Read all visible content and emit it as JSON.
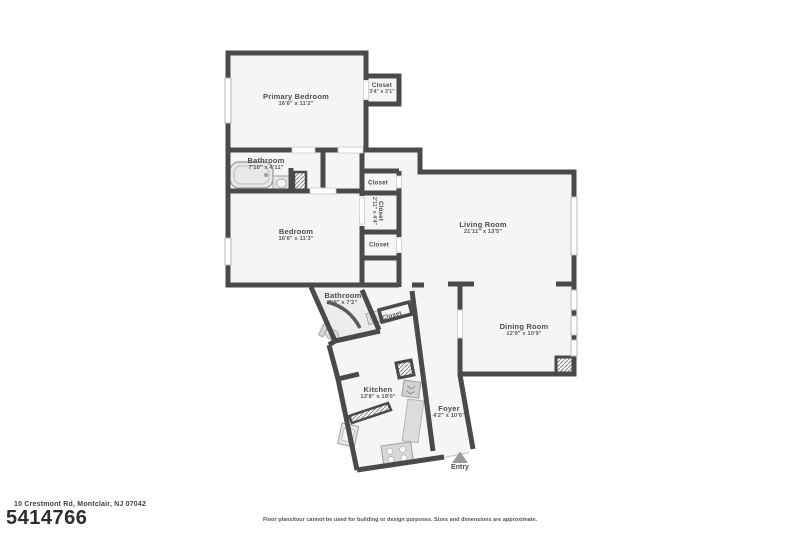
{
  "rooms": {
    "primary_bedroom": {
      "name": "Primary Bedroom",
      "dims": "16'6\" x 11'2\""
    },
    "closet_primary": {
      "name": "Closet",
      "dims": "3'4\" x 3'1\""
    },
    "bathroom_main": {
      "name": "Bathroom",
      "dims": "7'10\" x 4'11\""
    },
    "bedroom": {
      "name": "Bedroom",
      "dims": "16'6\" x 11'3\""
    },
    "closet_hall_top": {
      "name": "Closet",
      "dims": ""
    },
    "closet_hall_mid": {
      "name": "Closet",
      "dims": "2'11\" x 4'4\""
    },
    "closet_hall_bottom": {
      "name": "Closet",
      "dims": ""
    },
    "living_room": {
      "name": "Living Room",
      "dims": "21'11\" x 13'5\""
    },
    "dining_room": {
      "name": "Dining Room",
      "dims": "12'9\" x 10'9\""
    },
    "bathroom_half": {
      "name": "Bathroom",
      "dims": "6'9\" x 7'2\""
    },
    "closet_entry": {
      "name": "Closet",
      "dims": ""
    },
    "kitchen": {
      "name": "Kitchen",
      "dims": "13'8\" x 19'0\""
    },
    "foyer": {
      "name": "Foyer",
      "dims": "4'2\" x 10'6\""
    },
    "entry": {
      "name": "Entry",
      "dims": ""
    }
  },
  "footer": {
    "address": "10 Crestmont Rd, Montclair, NJ 07042",
    "mls_number": "5414766",
    "disclaimer": "Floor plans/tour cannot be used for building or design purposes. Sizes and dimensions are approximate."
  },
  "colors": {
    "wall": "#4a4a4a",
    "floor": "#f5f5f5",
    "fixture": "#dcdcdc",
    "text": "#4d4d4d"
  }
}
